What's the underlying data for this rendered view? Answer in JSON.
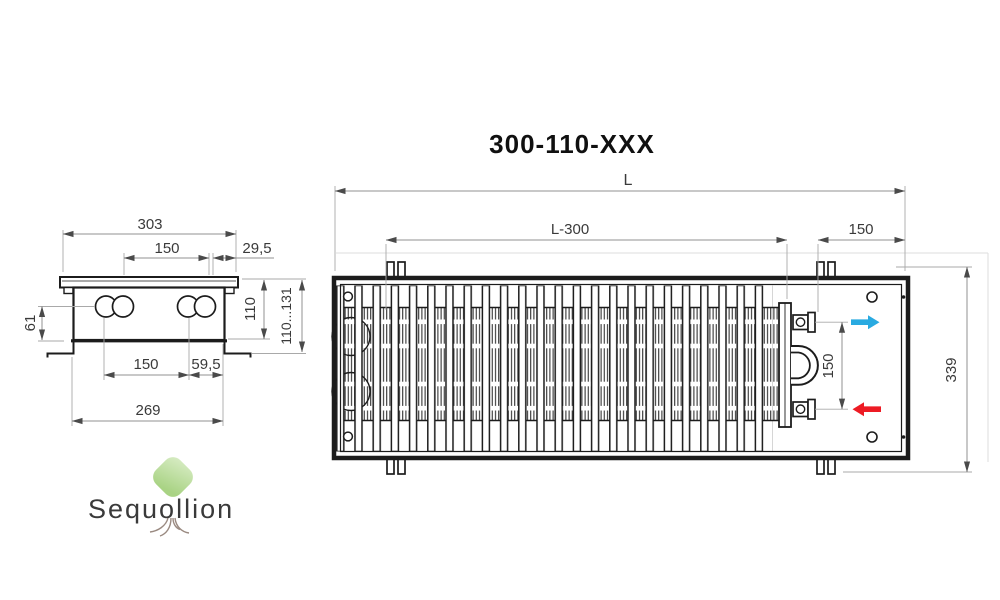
{
  "title": "300-110-XXX",
  "views": {
    "side": {
      "dims": {
        "overall_width": "303",
        "pipe_spacing_top": "150",
        "lip_overhang": "29,5",
        "pipe_axis_height": "61",
        "body_height": "110",
        "install_height_range": "110...131",
        "pipe_spacing_bottom": "150",
        "pipe_edge_offset": "59,5",
        "body_width": "269"
      }
    },
    "top": {
      "dims": {
        "overall_length": "L",
        "grille_length": "L-300",
        "connection_end_offset": "150",
        "overall_width": "339",
        "connection_spacing": "150"
      }
    }
  },
  "colors": {
    "line": "#1c1c1c",
    "dim_line": "#919191",
    "dim_text": "#3a3a3a",
    "arrow_head": "#4a4a4a",
    "inlet_blue": "#29aae1",
    "outlet_red": "#ed1b24",
    "logo_text": "#9a8a81",
    "leaf_light": "#d9edc6",
    "leaf_dark": "#a9d384"
  },
  "logo": {
    "text": "Sequollion"
  }
}
